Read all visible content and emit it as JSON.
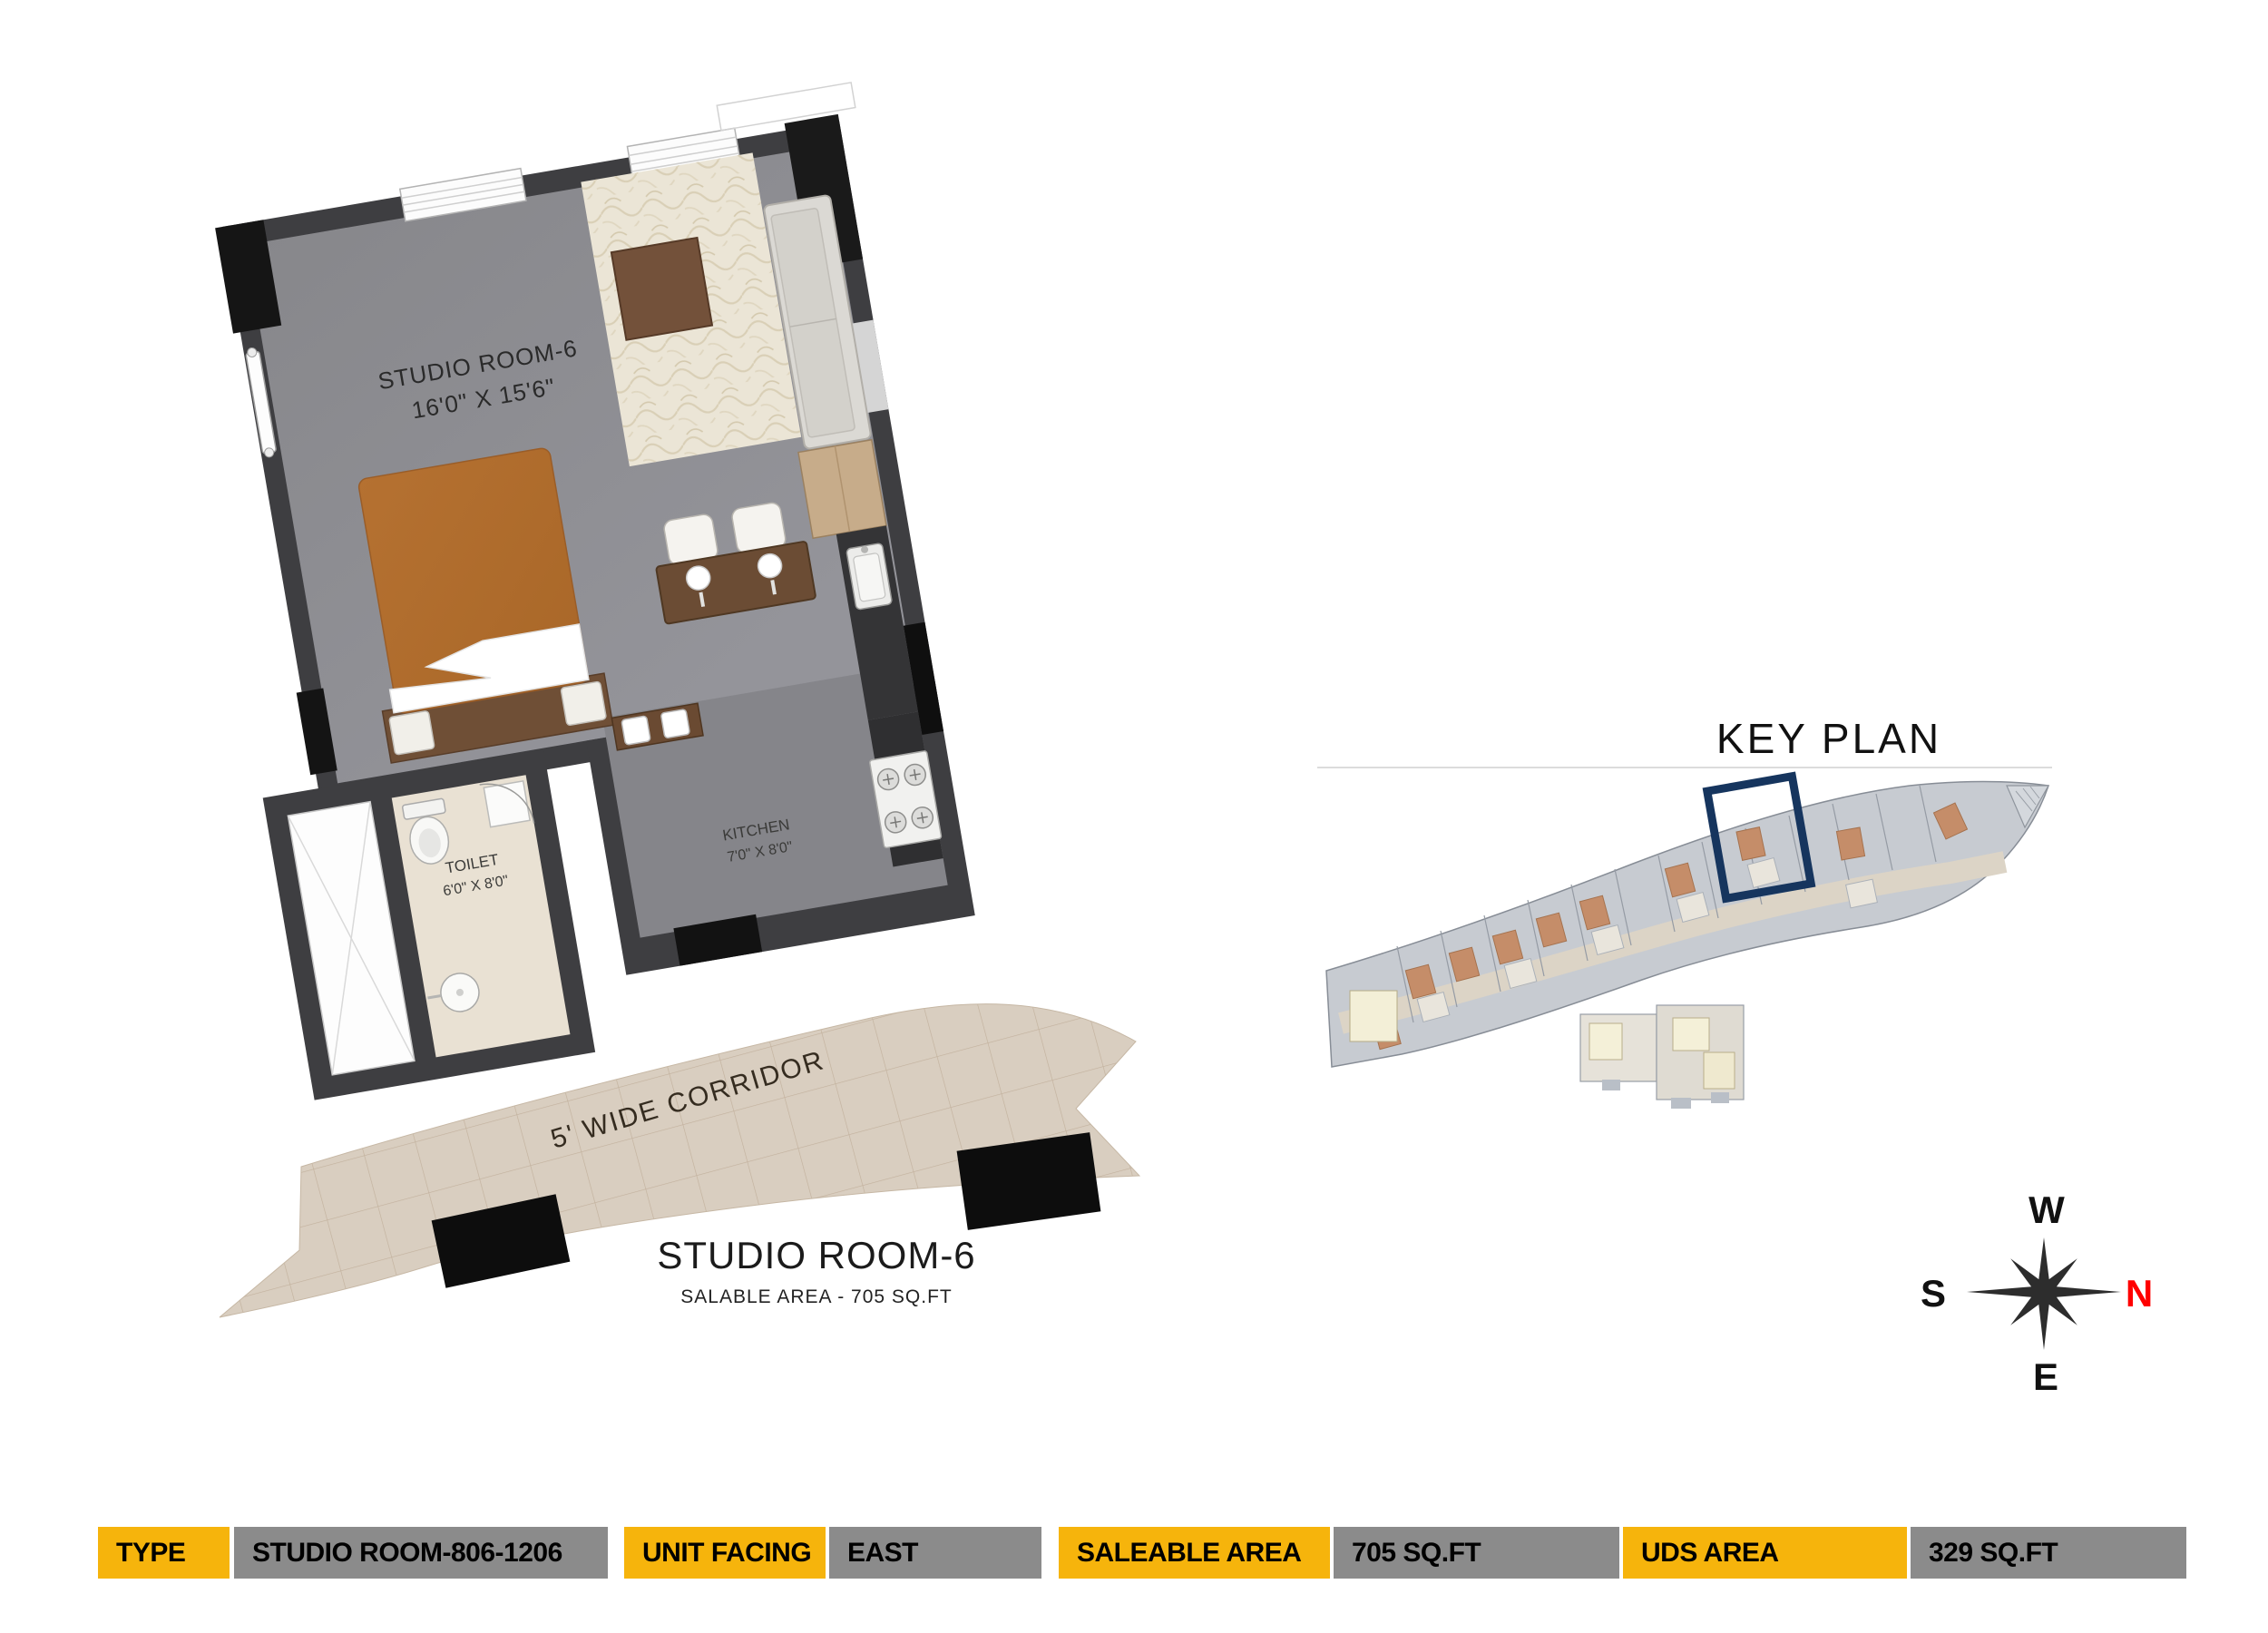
{
  "plan": {
    "room_name": "STUDIO ROOM-6",
    "room_dims": "16'0\" X 15'6\"",
    "toilet_name": "TOILET",
    "toilet_dims": "6'0\" X 8'0\"",
    "kitchen_name": "KITCHEN",
    "kitchen_dims": "7'0\" X 8'0\"",
    "corridor_label": "5' WIDE CORRIDOR",
    "title": "STUDIO ROOM-6",
    "subtitle": "SALABLE AREA - 705 SQ.FT"
  },
  "key_plan": {
    "title": "KEY PLAN",
    "highlight_color": "#16355E"
  },
  "compass": {
    "west": "W",
    "north": "N",
    "south": "S",
    "east": "E",
    "north_color": "#FF0000"
  },
  "spec_bar": {
    "items": [
      {
        "label": "TYPE",
        "value": "STUDIO ROOM-806-1206"
      },
      {
        "label": "UNIT FACING",
        "value": "EAST"
      },
      {
        "label": "SALEABLE AREA",
        "value": "705 SQ.FT"
      },
      {
        "label": "UDS AREA",
        "value": "329 SQ.FT"
      }
    ],
    "label_bg": "#F6B40C",
    "value_bg": "#8B8B8B"
  },
  "colors": {
    "wall_dark": "#3E3E41",
    "wall_black": "#141414",
    "floor_gray": "#8E8E92",
    "rug_cream": "#EBE5D6",
    "bed_orange": "#B37030",
    "toilet_beige": "#E9E1D3",
    "corridor_beige": "#D9CEC0"
  }
}
